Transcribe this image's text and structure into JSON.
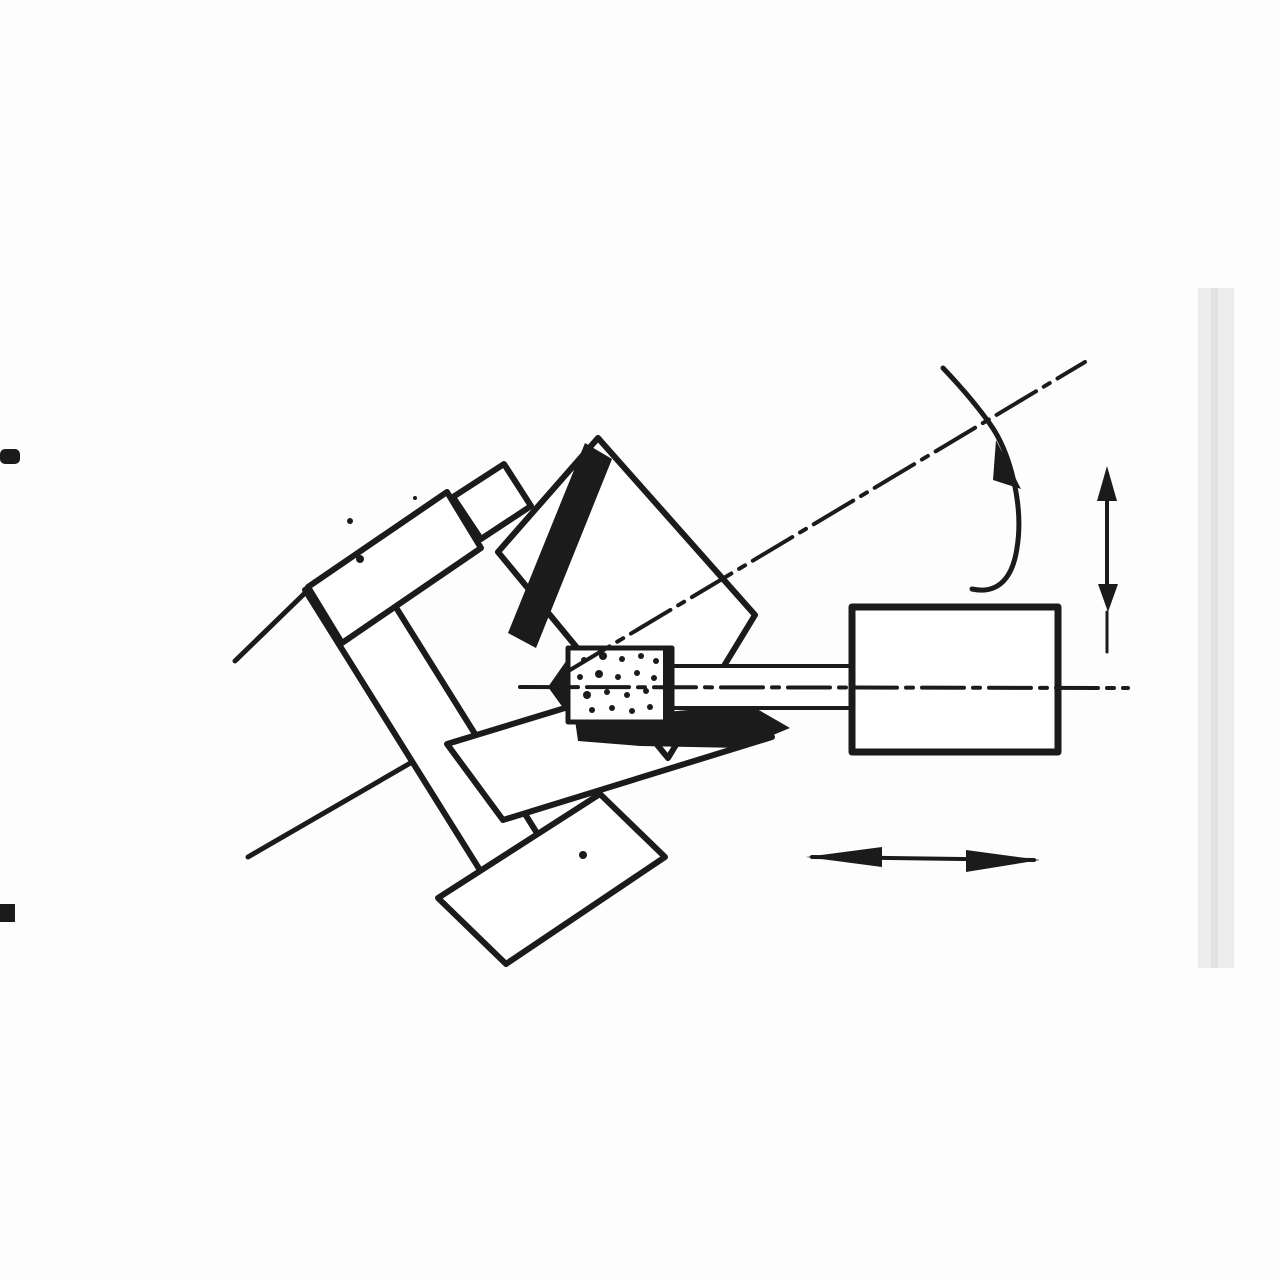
{
  "figure": {
    "description": "Scanned black-and-white engineering diagram of an internal taper grinding operation: a workpiece held in a stepped chuck on a workhead swivelled about 30 degrees, a stippled grinding wheel on a horizontal spindle quill entering the tapered bore, and a wheelhead block at the right. A curved arrow shows workpiece rotation about the inclined axis, a vertical double-headed arrow shows in-feed, and a horizontal double-headed arrow shows traverse. Scan artifacts: two black binding ticks at the left edge and a faint page-edge band at the right.",
    "background_color": "#fdfdfd",
    "ink_color": "#1b1b1b",
    "paper_white": "#ffffff",
    "page_edge_band_color": "#ededed",
    "page_edge_line_color": "#e2e2e2"
  },
  "canvas": {
    "width": 1280,
    "height": 1280
  },
  "shapes": [
    {
      "name": "page-edge-band",
      "kind": "rect",
      "x": 1198,
      "y": 288,
      "w": 36,
      "h": 680,
      "fill": "#ededed"
    },
    {
      "name": "page-edge-line",
      "kind": "rect",
      "x": 1211,
      "y": 288,
      "w": 7,
      "h": 680,
      "fill": "#e2e2e2"
    },
    {
      "name": "binding-mark-top",
      "kind": "rect",
      "x": 0,
      "y": 449,
      "w": 20,
      "h": 15,
      "fill": "#1b1b1b",
      "rx": 5
    },
    {
      "name": "binding-mark-bottom",
      "kind": "rect",
      "x": 0,
      "y": 904,
      "w": 15,
      "h": 18,
      "fill": "#1b1b1b"
    },
    {
      "name": "workhead-line-upper",
      "kind": "line",
      "x1": 235,
      "y1": 661,
      "x2": 306,
      "y2": 592,
      "w": 5
    },
    {
      "name": "workhead-line-lower",
      "kind": "line",
      "x1": 248,
      "y1": 857,
      "x2": 445,
      "y2": 743,
      "w": 5
    },
    {
      "name": "chuck-faceplate",
      "kind": "poly",
      "pts": [
        [
          305,
          590
        ],
        [
          362,
          553
        ],
        [
          565,
          878
        ],
        [
          508,
          915
        ]
      ],
      "fill": "#ffffff",
      "sw": 6
    },
    {
      "name": "chuck-bottom-jaw-stem",
      "kind": "poly",
      "pts": [
        [
          500,
          868
        ],
        [
          560,
          830
        ],
        [
          600,
          896
        ],
        [
          540,
          936
        ]
      ],
      "fill": "#ffffff",
      "sw": 6
    },
    {
      "name": "chuck-bottom-jaw-bar",
      "kind": "poly",
      "pts": [
        [
          438,
          898
        ],
        [
          600,
          794
        ],
        [
          665,
          857
        ],
        [
          506,
          964
        ]
      ],
      "fill": "#ffffff",
      "sw": 6
    },
    {
      "name": "chuck-lower-bar",
      "kind": "poly",
      "pts": [
        [
          447,
          744
        ],
        [
          716,
          662
        ],
        [
          772,
          737
        ],
        [
          503,
          820
        ]
      ],
      "fill": "#ffffff",
      "sw": 6
    },
    {
      "name": "workpiece-body",
      "kind": "poly",
      "pts": [
        [
          598,
          438
        ],
        [
          755,
          615
        ],
        [
          668,
          758
        ],
        [
          498,
          552
        ]
      ],
      "fill": "#ffffff",
      "sw": 6
    },
    {
      "name": "chuck-top-jaw",
      "kind": "poly",
      "pts": [
        [
          308,
          587
        ],
        [
          447,
          492
        ],
        [
          481,
          548
        ],
        [
          342,
          643
        ]
      ],
      "fill": "#ffffff",
      "sw": 6
    },
    {
      "name": "chuck-top-jaw-notch",
      "kind": "poly",
      "pts": [
        [
          453,
          497
        ],
        [
          504,
          464
        ],
        [
          531,
          506
        ],
        [
          481,
          539
        ]
      ],
      "fill": "#ffffff",
      "sw": 6
    },
    {
      "name": "chuck-speckle-1",
      "kind": "dot",
      "cx": 350,
      "cy": 521,
      "r": 3
    },
    {
      "name": "chuck-speckle-2",
      "kind": "dot",
      "cx": 360,
      "cy": 559,
      "r": 4
    },
    {
      "name": "chuck-speckle-3",
      "kind": "dot",
      "cx": 415,
      "cy": 498,
      "r": 2
    },
    {
      "name": "chuck-speckle-4",
      "kind": "dot",
      "cx": 583,
      "cy": 855,
      "r": 4
    },
    {
      "name": "bore-wall-section-upper",
      "kind": "poly",
      "pts": [
        [
          585,
          443
        ],
        [
          612,
          459
        ],
        [
          536,
          648
        ],
        [
          508,
          633
        ]
      ],
      "fill": "#1b1b1b",
      "sw": 0
    },
    {
      "name": "bore-cone-tip",
      "kind": "poly",
      "pts": [
        [
          548,
          687
        ],
        [
          569,
          657
        ],
        [
          569,
          716
        ]
      ],
      "fill": "#1b1b1b",
      "sw": 0
    },
    {
      "name": "bore-wall-section-lower",
      "kind": "poly",
      "pts": [
        [
          575,
          720
        ],
        [
          688,
          710
        ],
        [
          745,
          702
        ],
        [
          790,
          728
        ],
        [
          742,
          748
        ],
        [
          640,
          746
        ],
        [
          578,
          741
        ]
      ],
      "fill": "#1b1b1b",
      "sw": 0
    },
    {
      "name": "spindle-quill",
      "kind": "poly",
      "pts": [
        [
          672,
          666
        ],
        [
          852,
          666
        ],
        [
          852,
          708
        ],
        [
          672,
          708
        ]
      ],
      "fill": "#ffffff",
      "sw": 4
    },
    {
      "name": "grinding-wheel",
      "kind": "poly",
      "pts": [
        [
          568,
          648
        ],
        [
          672,
          648
        ],
        [
          672,
          722
        ],
        [
          568,
          722
        ]
      ],
      "fill": "#ffffff",
      "sw": 5
    },
    {
      "name": "grinding-wheel-edge",
      "kind": "line",
      "x1": 667,
      "y1": 651,
      "x2": 667,
      "y2": 719,
      "w": 8
    },
    {
      "name": "wheel-grit-dot",
      "kind": "dot",
      "cx": 584,
      "cy": 660,
      "r": 3
    },
    {
      "name": "wheel-grit-dot",
      "kind": "dot",
      "cx": 603,
      "cy": 656,
      "r": 4
    },
    {
      "name": "wheel-grit-dot",
      "kind": "dot",
      "cx": 622,
      "cy": 659,
      "r": 3
    },
    {
      "name": "wheel-grit-dot",
      "kind": "dot",
      "cx": 641,
      "cy": 656,
      "r": 3
    },
    {
      "name": "wheel-grit-dot",
      "kind": "dot",
      "cx": 656,
      "cy": 661,
      "r": 3
    },
    {
      "name": "wheel-grit-dot",
      "kind": "dot",
      "cx": 580,
      "cy": 677,
      "r": 3
    },
    {
      "name": "wheel-grit-dot",
      "kind": "dot",
      "cx": 599,
      "cy": 674,
      "r": 4
    },
    {
      "name": "wheel-grit-dot",
      "kind": "dot",
      "cx": 618,
      "cy": 677,
      "r": 3
    },
    {
      "name": "wheel-grit-dot",
      "kind": "dot",
      "cx": 637,
      "cy": 673,
      "r": 3
    },
    {
      "name": "wheel-grit-dot",
      "kind": "dot",
      "cx": 654,
      "cy": 678,
      "r": 3
    },
    {
      "name": "wheel-grit-dot",
      "kind": "dot",
      "cx": 587,
      "cy": 695,
      "r": 4
    },
    {
      "name": "wheel-grit-dot",
      "kind": "dot",
      "cx": 607,
      "cy": 692,
      "r": 3
    },
    {
      "name": "wheel-grit-dot",
      "kind": "dot",
      "cx": 627,
      "cy": 695,
      "r": 3
    },
    {
      "name": "wheel-grit-dot",
      "kind": "dot",
      "cx": 646,
      "cy": 691,
      "r": 3
    },
    {
      "name": "wheel-grit-dot",
      "kind": "dot",
      "cx": 592,
      "cy": 710,
      "r": 3
    },
    {
      "name": "wheel-grit-dot",
      "kind": "dot",
      "cx": 612,
      "cy": 708,
      "r": 3
    },
    {
      "name": "wheel-grit-dot",
      "kind": "dot",
      "cx": 632,
      "cy": 711,
      "r": 3
    },
    {
      "name": "wheel-grit-dot",
      "kind": "dot",
      "cx": 650,
      "cy": 707,
      "r": 3
    },
    {
      "name": "wheelhead-block",
      "kind": "poly",
      "pts": [
        [
          852,
          607
        ],
        [
          1058,
          607
        ],
        [
          1058,
          752
        ],
        [
          852,
          752
        ]
      ],
      "fill": "#ffffff",
      "sw": 7
    },
    {
      "name": "spindle-centerline",
      "kind": "line",
      "x1": 520,
      "y1": 687,
      "x2": 1128,
      "y2": 688,
      "w": 4,
      "dash": "42 9 7 9"
    },
    {
      "name": "workpiece-centerline",
      "kind": "line",
      "x1": 570,
      "y1": 670,
      "x2": 1085,
      "y2": 362,
      "w": 4,
      "dash": "46 9 7 9"
    },
    {
      "name": "rotation-arrow-curve",
      "kind": "path",
      "d": "M 943,368 C 962,388 978,407 990,424 C 1010,452 1024,505 1017,548 C 1012,582 995,594 972,589",
      "sw": 5
    },
    {
      "name": "rotation-arrow-head",
      "kind": "poly",
      "pts": [
        [
          996,
          440
        ],
        [
          1021,
          489
        ],
        [
          993,
          480
        ]
      ],
      "fill": "#1b1b1b",
      "sw": 0
    },
    {
      "name": "infeed-arrow-shaft",
      "kind": "line",
      "x1": 1107,
      "y1": 480,
      "x2": 1107,
      "y2": 600,
      "w": 4
    },
    {
      "name": "infeed-arrow-shaft-ext",
      "kind": "line",
      "x1": 1107,
      "y1": 612,
      "x2": 1107,
      "y2": 652,
      "w": 3
    },
    {
      "name": "infeed-arrow-head-up",
      "kind": "poly",
      "pts": [
        [
          1107,
          466
        ],
        [
          1097,
          501
        ],
        [
          1117,
          501
        ]
      ],
      "fill": "#1b1b1b",
      "sw": 0
    },
    {
      "name": "infeed-arrow-head-down",
      "kind": "poly",
      "pts": [
        [
          1108,
          612
        ],
        [
          1098,
          584
        ],
        [
          1118,
          584
        ]
      ],
      "fill": "#1b1b1b",
      "sw": 0
    },
    {
      "name": "traverse-arrow-shaft",
      "kind": "line",
      "x1": 812,
      "y1": 857,
      "x2": 1034,
      "y2": 860,
      "w": 4
    },
    {
      "name": "traverse-arrow-head-left",
      "kind": "poly",
      "pts": [
        [
          806,
          857
        ],
        [
          882,
          847
        ],
        [
          882,
          867
        ]
      ],
      "fill": "#1b1b1b",
      "sw": 0
    },
    {
      "name": "traverse-arrow-head-right",
      "kind": "poly",
      "pts": [
        [
          1040,
          860
        ],
        [
          966,
          850
        ],
        [
          966,
          872
        ]
      ],
      "fill": "#1b1b1b",
      "sw": 0
    }
  ]
}
